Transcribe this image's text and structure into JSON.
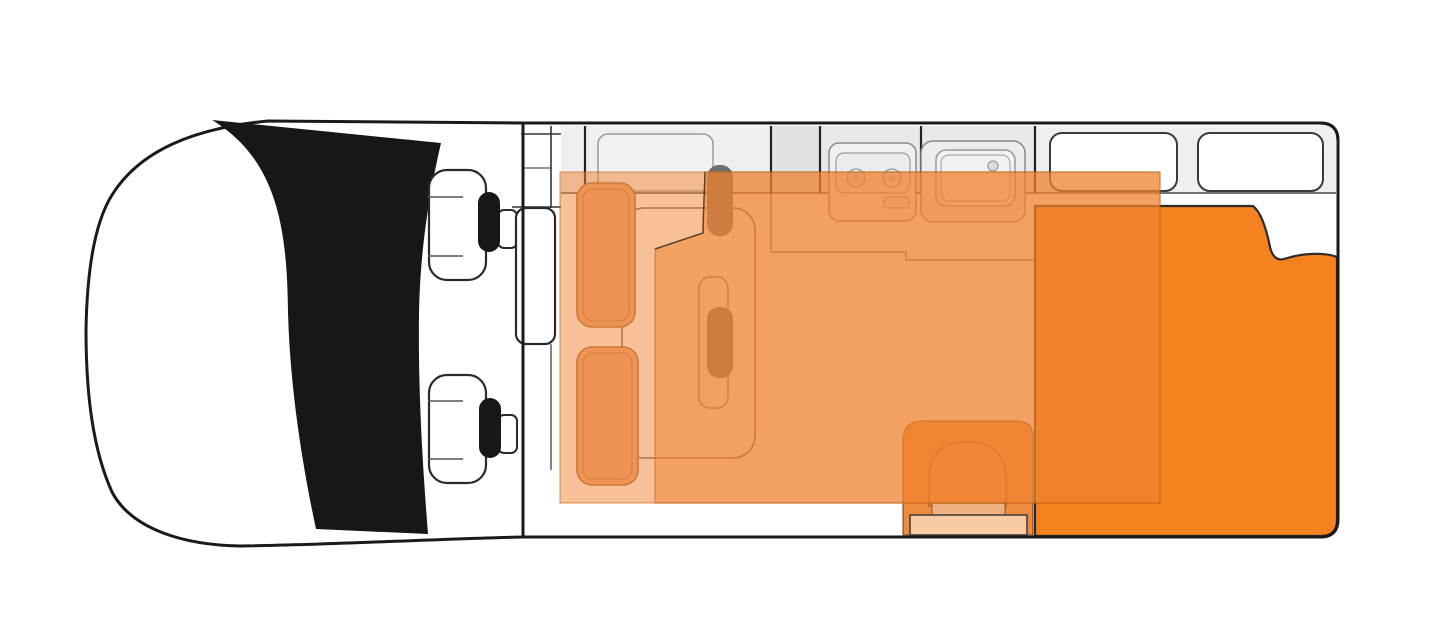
{
  "diagram": {
    "kind": "campervan-floorplan-top-view",
    "orientation": "front-of-vehicle-left",
    "features": {
      "cab_seats": 2,
      "lounge_bench_seats": 2,
      "stove_burners": 2,
      "sinks": 1,
      "front_wall_windows": 1,
      "rear_wall_windows": 2,
      "bed_overlays": 2,
      "rear_bed_with_folded_corner": 1,
      "entry_steps": 2
    },
    "colors": {
      "outline_black": "#1a1a1a",
      "windshield_black": "#171717",
      "body_white": "#ffffff",
      "wall_band_gray": "#efefef",
      "wall_band_gray_dark": "#e2e2e2",
      "wall_band_gray_mid": "#e9e9e9",
      "window_white": "#ffffff",
      "unit_gray_fill": "#f0f0f0",
      "unit_gray_line": "#8a8a8a",
      "bed_solid_orange": "#f5821f",
      "bed_overlay_orange": "rgba(240,130,45,0.5)",
      "overlay_edge_line": "rgba(185,95,20,0.55)",
      "fold_line_dark": "rgba(60,45,35,0.8)",
      "bench_orange": "#eca47b",
      "bench_outline": "#a8713f",
      "cubicle_orange": "#f08a3e",
      "arch_orange": "#f2994f",
      "step_upper_orange": "#efaf7e",
      "step_lower_peach": "#f8cba4",
      "belt_gray": "#6e6e6e",
      "headrest_black": "#171717"
    }
  }
}
